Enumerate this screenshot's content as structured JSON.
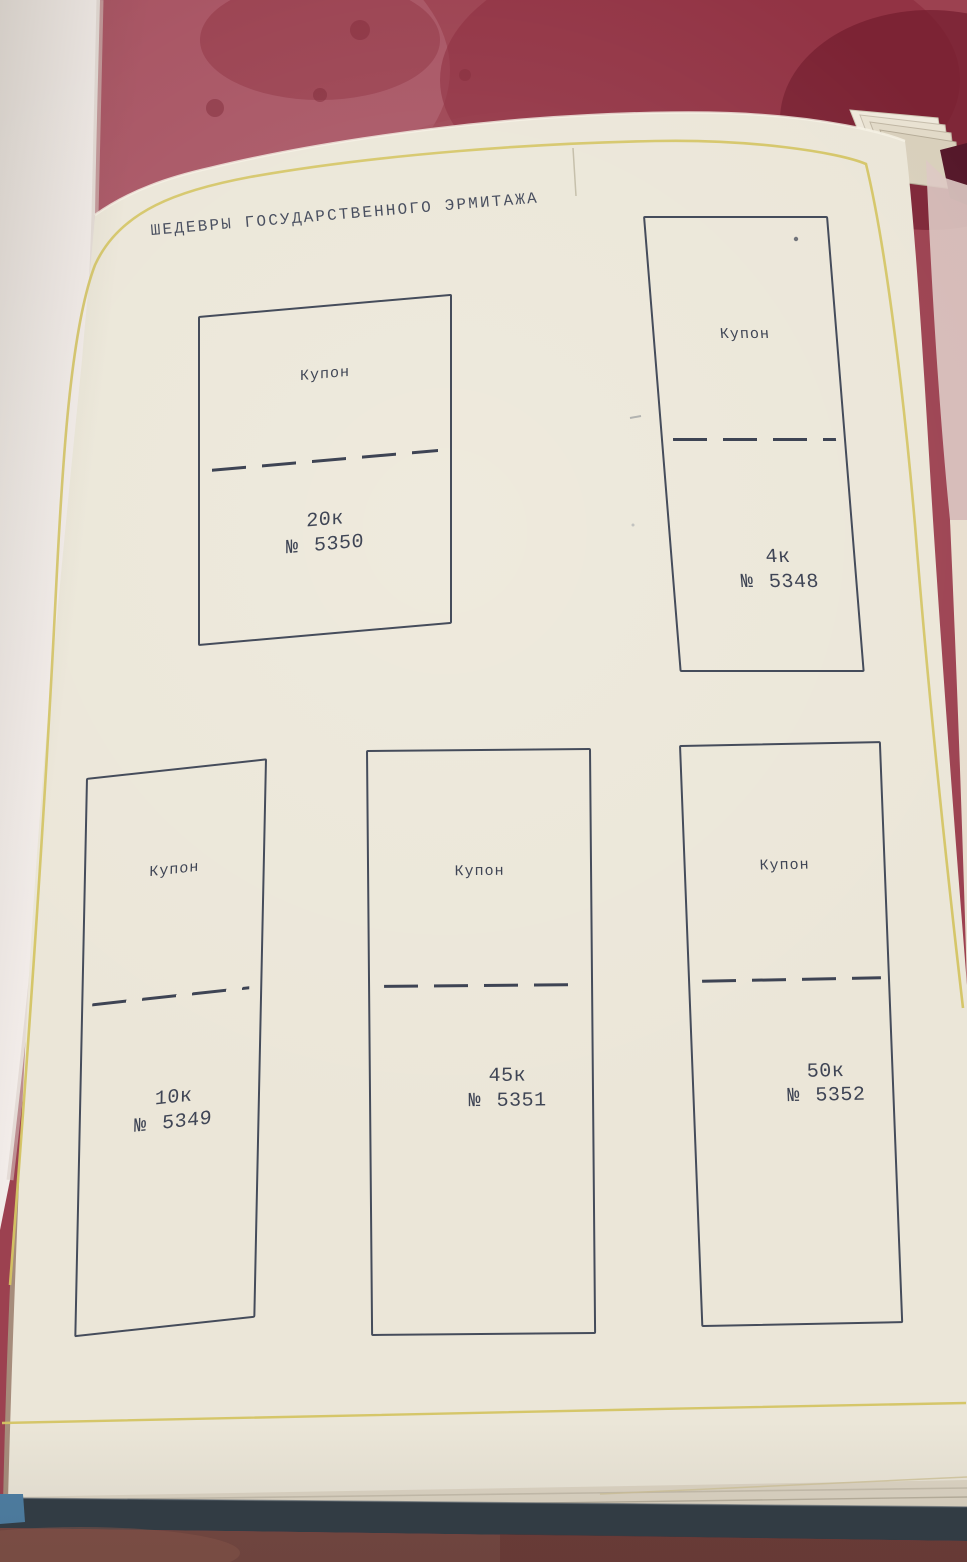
{
  "album": {
    "title": "ШЕДЕВРЫ ГОСУДАРСТВЕННОГО ЭРМИТАЖА",
    "slots": [
      {
        "label": "Купон",
        "denomination": "20к",
        "number": "№ 5350"
      },
      {
        "label": "Купон",
        "denomination": "4к",
        "number": "№ 5348"
      },
      {
        "label": "Купон",
        "denomination": "10к",
        "number": "№ 5349"
      },
      {
        "label": "Купон",
        "denomination": "45к",
        "number": "№ 5351"
      },
      {
        "label": "Купон",
        "denomination": "50к",
        "number": "№ 5352"
      }
    ],
    "colors": {
      "cloth_red": "#9c4150",
      "page_cream": "#ebe6d8",
      "frame_yellow": "#d4c463",
      "ink": "#3f4555",
      "cover_dark": "#323d46",
      "cover_blue": "#4d7fa4",
      "carpet_brown": "#744741"
    }
  }
}
